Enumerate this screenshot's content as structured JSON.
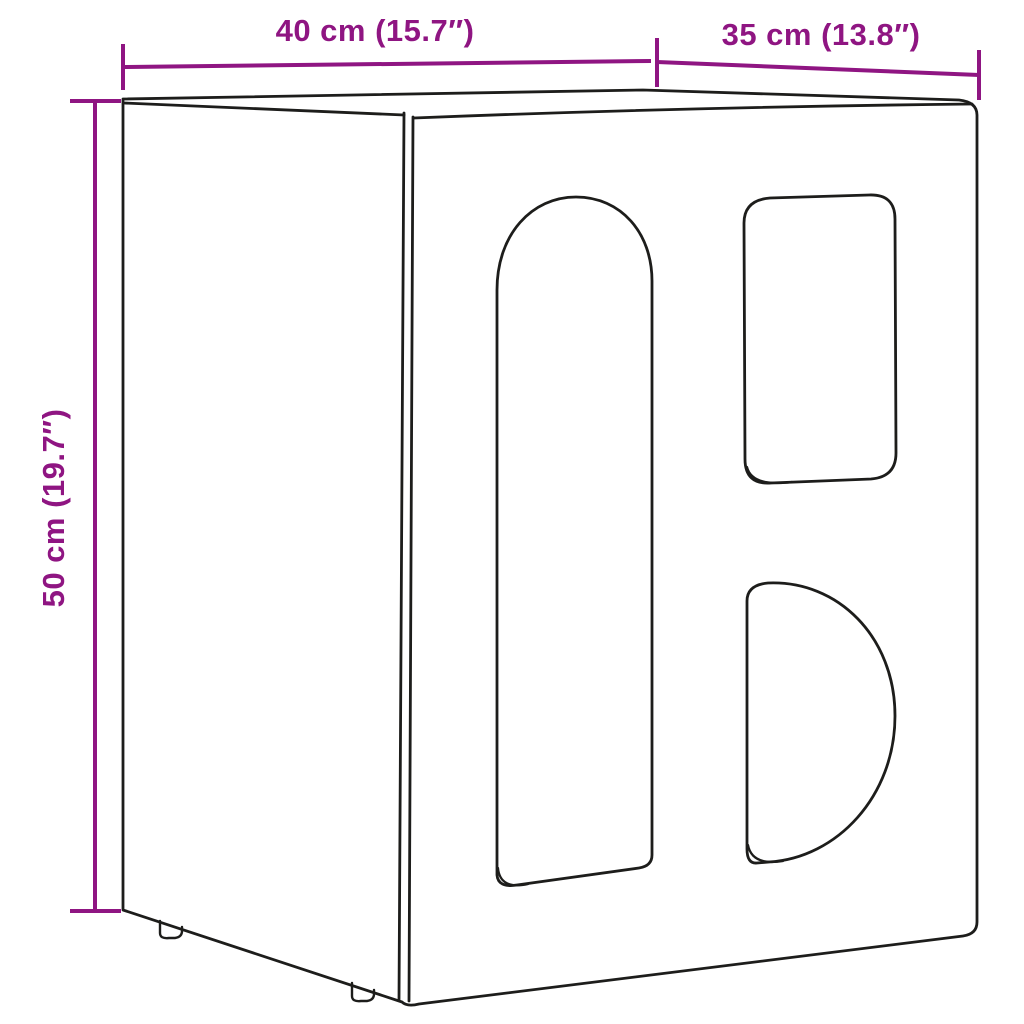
{
  "diagram": {
    "kind": "product-dimension-drawing",
    "dimensions": {
      "width": {
        "label": "40 cm (15.7″)",
        "cm": 40,
        "inches": 15.7,
        "orientation": "horizontal-top-left"
      },
      "depth": {
        "label": "35 cm (13.8″)",
        "cm": 35,
        "inches": 13.8,
        "orientation": "horizontal-top-right"
      },
      "height": {
        "label": "50 cm (19.7″)",
        "cm": 50,
        "inches": 19.7,
        "orientation": "vertical-left-rotated"
      }
    },
    "colors": {
      "dimension": "#8f1582",
      "outline": "#1d1d1b",
      "background": "#ffffff"
    },
    "features": {
      "cutouts": [
        "arch",
        "rounded-rectangle",
        "semicircle"
      ],
      "feet_visible": 2
    }
  }
}
